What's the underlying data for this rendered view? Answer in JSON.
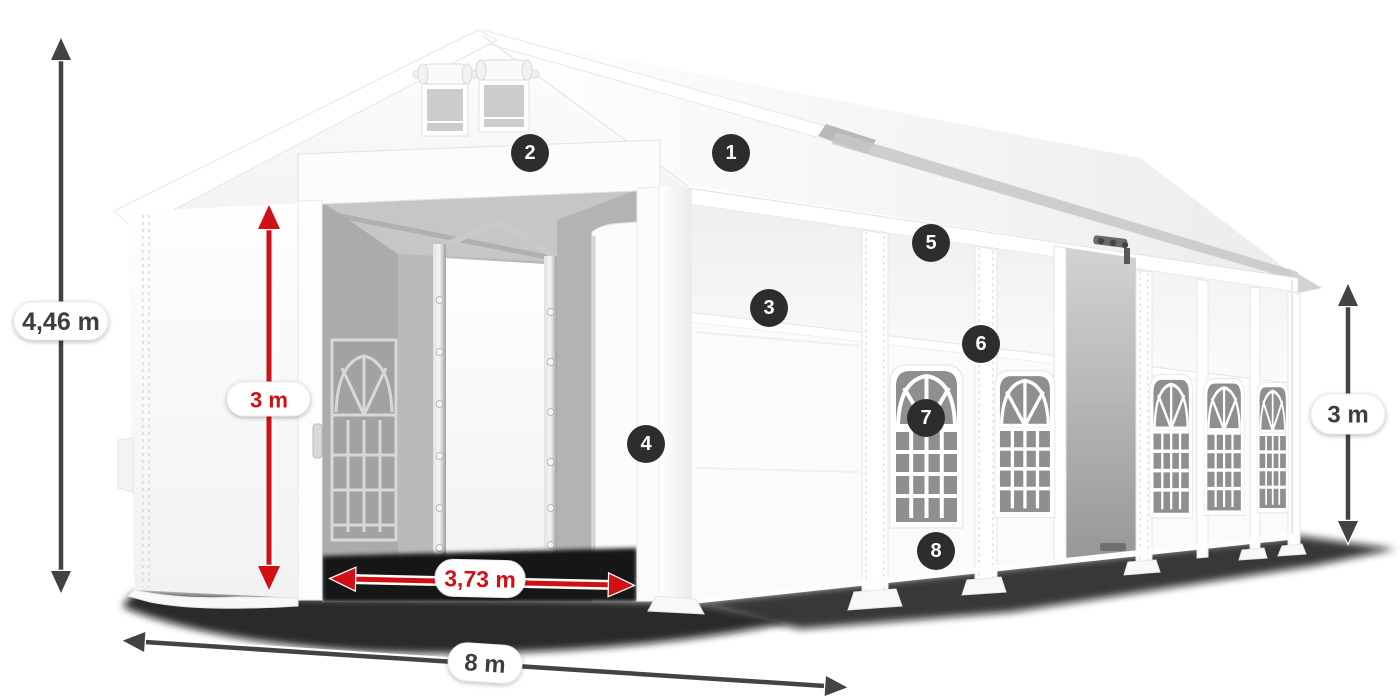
{
  "dimensions": {
    "total_height_label": "4,46 m",
    "entrance_height_label": "3 m",
    "entrance_width_label": "3,73 m",
    "front_width_label": "8 m",
    "side_wall_height_label": "3 m"
  },
  "markers": [
    {
      "label": "1"
    },
    {
      "label": "2"
    },
    {
      "label": "3"
    },
    {
      "label": "4"
    },
    {
      "label": "5"
    },
    {
      "label": "6"
    },
    {
      "label": "7"
    },
    {
      "label": "8"
    }
  ],
  "colors": {
    "dimension_red": "#d11015",
    "dimension_dark": "#434343",
    "marker_background": "#2d2d2d",
    "marker_text": "#ffffff",
    "background": "#ffffff"
  }
}
